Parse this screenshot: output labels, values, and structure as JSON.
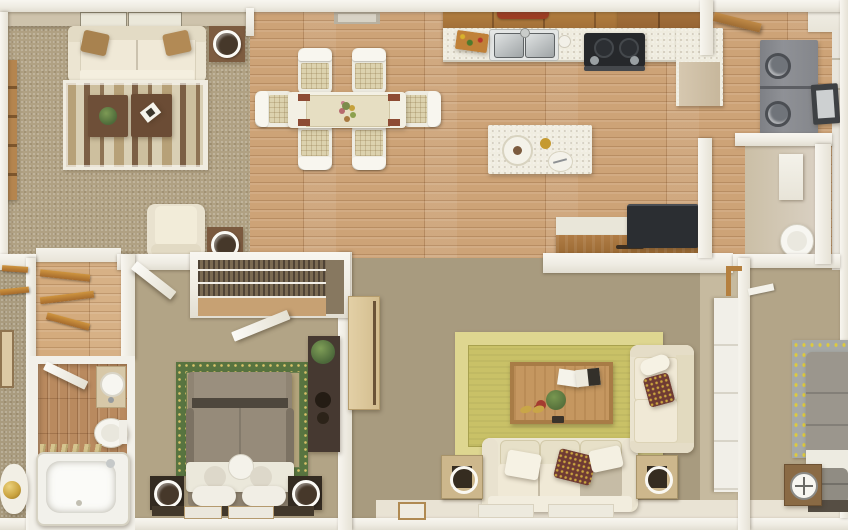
{
  "scene": {
    "kind": "3d-floorplan-top-down-render",
    "description": "Photorealistic dollhouse-style top view of a residential home interior with no visible text",
    "width_px": 848,
    "height_px": 530
  },
  "palette": {
    "wall_white": "#f3f1ea",
    "carpet_living": "#b0a183",
    "carpet_family": "#a89b7f",
    "carpet_bedroom1": "#b2a486",
    "carpet_bedroom2": "#b3a588",
    "oak_floor": "#cda377",
    "bath_wood_floor": "#b98a5f",
    "cream_upholstery": "#ece6d3",
    "dark_coffee_table": "#6e4f38",
    "kitchen_cabinet_wood": "#a9753f",
    "red_valance": "#9d3d23",
    "yellow_rug_field": "#c9c167",
    "yellow_rug_border": "#ded790",
    "green_rug_border": "#587440",
    "washer_gray": "#87898e",
    "tv_black": "#2b2e32",
    "gold_lamp": "#c9a23e"
  },
  "rooms": [
    {
      "id": "living-room",
      "position": "top-left",
      "flooring": "tan carpet",
      "contents": [
        "cream sofa with two brown accent pillows",
        "striped area rug with white border",
        "two dark brown cube coffee tables with plant and magazine",
        "cream armchair",
        "wood bookshelf",
        "two square side tables with ring-shade lamps",
        "ceiling light panels"
      ]
    },
    {
      "id": "dining-area",
      "position": "top-center",
      "flooring": "light oak plank",
      "contents": [
        "white dining table with beige runner and floral centerpiece",
        "six white chairs with woven beige seat pads",
        "red-brown placemats",
        "ceiling vent"
      ]
    },
    {
      "id": "kitchen",
      "position": "top-center-right",
      "flooring": "light oak plank",
      "contents": [
        "upper wood cabinets",
        "red scalloped valance",
        "white speckled countertop with L return",
        "double stainless sink",
        "black cooktop with handle and knobs",
        "cutting board with vegetables",
        "white island with place settings"
      ]
    },
    {
      "id": "media-nook",
      "position": "center-right",
      "contents": [
        "wood desk console with drawer",
        "black TV monitor",
        "white pony wall"
      ]
    },
    {
      "id": "laundry-hall",
      "position": "top-right",
      "flooring": "light oak plank",
      "contents": [
        "stacked gray washer and dryer with round doors",
        "open appliance door",
        "wood entry door ajar"
      ]
    },
    {
      "id": "powder-room",
      "position": "right",
      "contents": [
        "white vanity cabinet",
        "round white toilet"
      ]
    },
    {
      "id": "hallway",
      "position": "center-left",
      "flooring": "oak plank",
      "contents": [
        "open wood shelf boards",
        "white interior doors ajar",
        "slatted closet with wire shelves"
      ]
    },
    {
      "id": "bathroom",
      "position": "bottom-left",
      "flooring": "wood plank",
      "contents": [
        "white bathtub",
        "toilet",
        "vanity sink",
        "bamboo towel rack",
        "door ajar"
      ]
    },
    {
      "id": "bedroom-1",
      "position": "bottom-center-left",
      "flooring": "tan carpet",
      "contents": [
        "bed with white throw and round cushions",
        "green-bordered area rug",
        "two ring-shade lamps on dark stands",
        "dark dresser with plant",
        "bench with white mats"
      ]
    },
    {
      "id": "family-room",
      "position": "bottom-center-right",
      "flooring": "taupe carpet",
      "contents": [
        "chartreuse bordered rug",
        "wood coffee table with magazines plant flowers slippers",
        "cream three-seat sofa with damask pillow",
        "cream loveseat",
        "two cube side tables with ring lamps",
        "pale wood TV console",
        "floor mats"
      ]
    },
    {
      "id": "bedroom-2",
      "position": "bottom-right",
      "flooring": "tan carpet",
      "contents": [
        "gray bed partially cropped",
        "gray rug with yellow floral pattern",
        "nightstand with compass clock",
        "sliding-door closet"
      ]
    },
    {
      "id": "left-bedroom-edge",
      "position": "left-edge",
      "contents": [
        "closet shelf boards",
        "wall art",
        "gold sphere lamp"
      ]
    }
  ]
}
